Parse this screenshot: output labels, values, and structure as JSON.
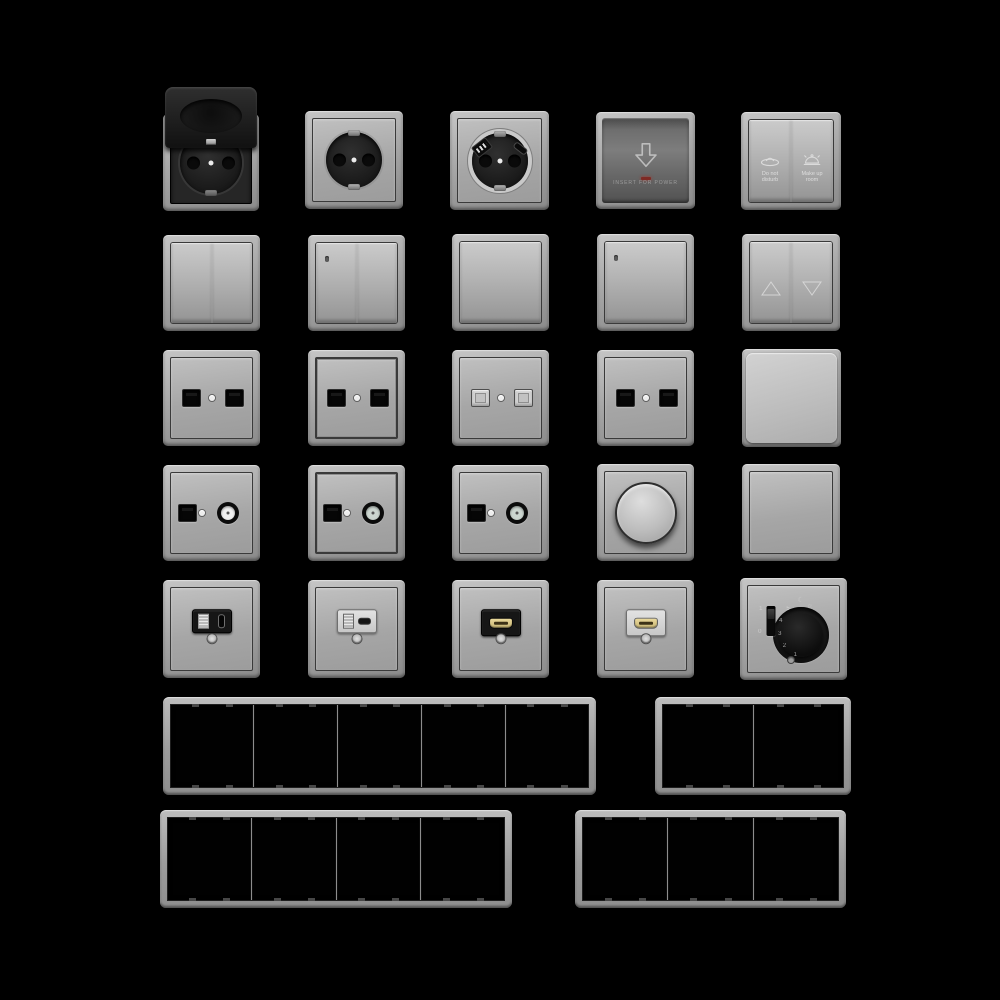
{
  "canvas": {
    "width": 1000,
    "height": 1000,
    "background": "#000000"
  },
  "palette": {
    "plate_gray_light": "#c6c6c6",
    "plate_gray_dark": "#8b8b8b",
    "device_black": "#161616",
    "keycard_face_gray": "#6e6e6e",
    "led_red": "#7e2a24",
    "hdmi_gold": "#d8c783",
    "frame_opening_black": "#010101"
  },
  "items": [
    {
      "name": "socket-flip-cover",
      "type": "flip_socket",
      "x": 163,
      "y": 87,
      "w": 96,
      "h": 124
    },
    {
      "name": "schuko-socket",
      "type": "schuko",
      "x": 305,
      "y": 111,
      "w": 98,
      "h": 98
    },
    {
      "name": "schuko-usb-socket",
      "type": "schuko_usb",
      "x": 450,
      "y": 111,
      "w": 99,
      "h": 99
    },
    {
      "name": "keycard-power-switch",
      "type": "keycard",
      "x": 596,
      "y": 112,
      "w": 99,
      "h": 97,
      "icon": "down-arrow-icon",
      "label": "INSERT FOR POWER"
    },
    {
      "name": "hotel-service-switch",
      "type": "hotel",
      "x": 741,
      "y": 112,
      "w": 100,
      "h": 98,
      "left_icon": "do-not-disturb-icon",
      "left_label": "Do not disturb",
      "right_icon": "service-bell-icon",
      "right_label": "Make up room"
    },
    {
      "name": "double-rocker-switch",
      "type": "rocker2",
      "x": 163,
      "y": 235,
      "w": 97,
      "h": 96
    },
    {
      "name": "double-rocker-switch-indicator",
      "type": "rocker2",
      "led": true,
      "x": 308,
      "y": 235,
      "w": 97,
      "h": 96
    },
    {
      "name": "single-rocker-switch",
      "type": "rocker1",
      "x": 452,
      "y": 234,
      "w": 97,
      "h": 97
    },
    {
      "name": "single-rocker-switch-indicator",
      "type": "rocker1",
      "led": true,
      "x": 597,
      "y": 234,
      "w": 97,
      "h": 97
    },
    {
      "name": "shutter-switch",
      "type": "shutter",
      "x": 742,
      "y": 234,
      "w": 98,
      "h": 97,
      "left_icon": "up-triangle-icon",
      "right_icon": "down-triangle-icon"
    },
    {
      "name": "dual-data-outlet-black-1",
      "type": "data2",
      "color": "black",
      "x": 163,
      "y": 350,
      "w": 97,
      "h": 96
    },
    {
      "name": "dual-data-outlet-black-2",
      "type": "data2",
      "color": "black",
      "raised": true,
      "x": 308,
      "y": 350,
      "w": 97,
      "h": 96
    },
    {
      "name": "dual-data-outlet-white",
      "type": "data2",
      "color": "white",
      "x": 452,
      "y": 350,
      "w": 97,
      "h": 96
    },
    {
      "name": "dual-data-outlet-black-3",
      "type": "data2",
      "color": "black",
      "x": 597,
      "y": 350,
      "w": 97,
      "h": 96
    },
    {
      "name": "flat-push-plate",
      "type": "push_plate",
      "x": 742,
      "y": 349,
      "w": 99,
      "h": 98
    },
    {
      "name": "tv-data-outlet-1",
      "type": "tv",
      "coax_center": "#f0f0f0",
      "x": 163,
      "y": 465,
      "w": 97,
      "h": 96
    },
    {
      "name": "tv-data-outlet-2",
      "type": "tv",
      "raised": true,
      "coax_center": "#ccd6d0",
      "x": 308,
      "y": 465,
      "w": 97,
      "h": 96
    },
    {
      "name": "tv-data-outlet-3",
      "type": "tv",
      "coax_center": "#ccd6d0",
      "x": 452,
      "y": 465,
      "w": 97,
      "h": 96
    },
    {
      "name": "rotary-dimmer",
      "type": "dimmer",
      "x": 597,
      "y": 464,
      "w": 97,
      "h": 97
    },
    {
      "name": "blank-plate",
      "type": "blank",
      "x": 742,
      "y": 464,
      "w": 98,
      "h": 97
    },
    {
      "name": "usb-charger-outlet-black",
      "type": "usb",
      "color": "black",
      "x": 163,
      "y": 580,
      "w": 97,
      "h": 98
    },
    {
      "name": "usb-charger-outlet-white",
      "type": "usb",
      "color": "white",
      "x": 308,
      "y": 580,
      "w": 97,
      "h": 98
    },
    {
      "name": "hdmi-outlet-black",
      "type": "hdmi",
      "color": "black",
      "x": 452,
      "y": 580,
      "w": 97,
      "h": 98
    },
    {
      "name": "hdmi-outlet-white",
      "type": "hdmi",
      "color": "white",
      "x": 597,
      "y": 580,
      "w": 97,
      "h": 98
    },
    {
      "name": "thermostat-dial",
      "type": "thermostat",
      "x": 740,
      "y": 578,
      "w": 107,
      "h": 102,
      "dial_numbers": [
        "5",
        "4",
        "3",
        "2",
        "1"
      ],
      "slider_top": "1",
      "slider_bottom": "0",
      "icons": [
        "moon-icon",
        "sun-icon"
      ]
    },
    {
      "name": "frame-5-gang",
      "type": "frame",
      "gangs": 5,
      "x": 163,
      "y": 697,
      "w": 433,
      "h": 98
    },
    {
      "name": "frame-2-gang",
      "type": "frame",
      "gangs": 2,
      "x": 655,
      "y": 697,
      "w": 196,
      "h": 98
    },
    {
      "name": "frame-4-gang",
      "type": "frame",
      "gangs": 4,
      "x": 160,
      "y": 810,
      "w": 352,
      "h": 98
    },
    {
      "name": "frame-3-gang",
      "type": "frame",
      "gangs": 3,
      "x": 575,
      "y": 810,
      "w": 271,
      "h": 98
    }
  ]
}
